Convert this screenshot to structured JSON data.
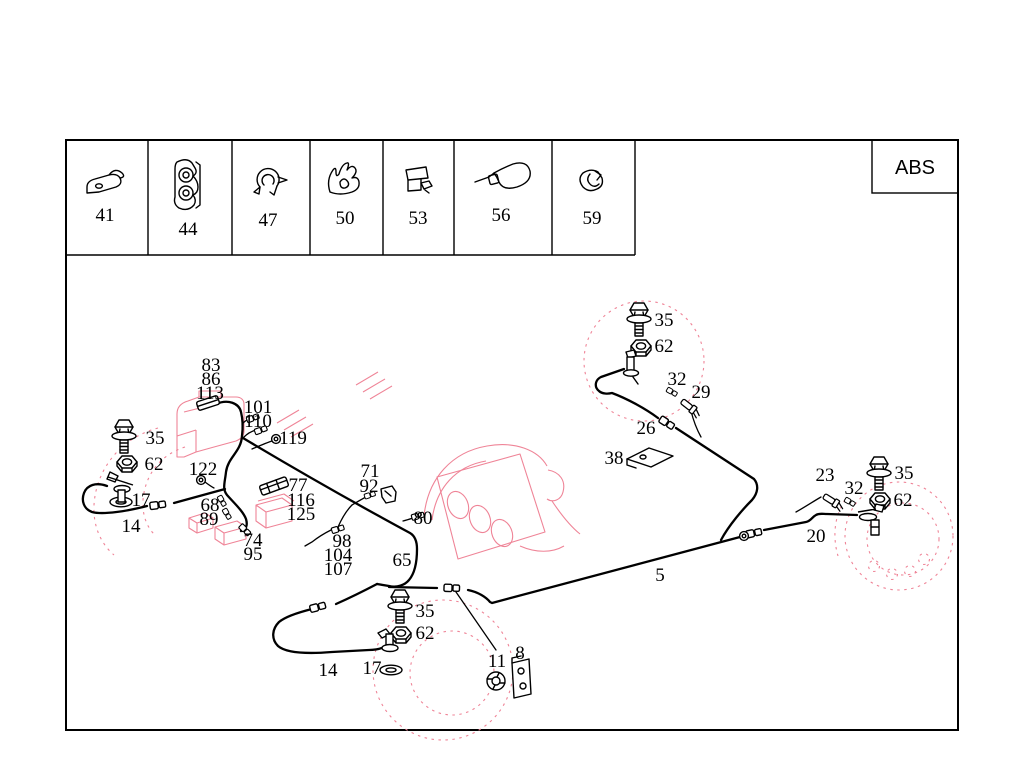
{
  "title": "brake-lines-abs-parts-diagram",
  "abs_badge": "ABS",
  "colors": {
    "line": "#000000",
    "ghost": "#ef8497",
    "background": "#ffffff"
  },
  "legend": [
    {
      "number": "41",
      "icon": "strap-clip"
    },
    {
      "number": "44",
      "icon": "double-pipe-clamp"
    },
    {
      "number": "47",
      "icon": "round-clip"
    },
    {
      "number": "50",
      "icon": "spring-clip"
    },
    {
      "number": "53",
      "icon": "bracket-clip"
    },
    {
      "number": "56",
      "icon": "cable-tie"
    },
    {
      "number": "59",
      "icon": "hose-clamp"
    }
  ],
  "callouts": [
    {
      "text": "41",
      "x": 105,
      "y": 221
    },
    {
      "text": "44",
      "x": 188,
      "y": 235
    },
    {
      "text": "47",
      "x": 268,
      "y": 226
    },
    {
      "text": "50",
      "x": 345,
      "y": 224
    },
    {
      "text": "53",
      "x": 418,
      "y": 224
    },
    {
      "text": "56",
      "x": 501,
      "y": 221
    },
    {
      "text": "59",
      "x": 592,
      "y": 224
    },
    {
      "text": "83",
      "x": 211,
      "y": 371
    },
    {
      "text": "86",
      "x": 211,
      "y": 385
    },
    {
      "text": "113",
      "x": 210,
      "y": 399
    },
    {
      "text": "101",
      "x": 258,
      "y": 413
    },
    {
      "text": "110",
      "x": 258,
      "y": 427
    },
    {
      "text": "119",
      "x": 293,
      "y": 444
    },
    {
      "text": "35",
      "x": 155,
      "y": 444
    },
    {
      "text": "62",
      "x": 154,
      "y": 470
    },
    {
      "text": "122",
      "x": 203,
      "y": 475
    },
    {
      "text": "17",
      "x": 141,
      "y": 506
    },
    {
      "text": "14",
      "x": 131,
      "y": 532
    },
    {
      "text": "68",
      "x": 210,
      "y": 511
    },
    {
      "text": "89",
      "x": 209,
      "y": 525
    },
    {
      "text": "77",
      "x": 298,
      "y": 491
    },
    {
      "text": "116",
      "x": 301,
      "y": 506
    },
    {
      "text": "125",
      "x": 301,
      "y": 520
    },
    {
      "text": "74",
      "x": 253,
      "y": 546
    },
    {
      "text": "95",
      "x": 253,
      "y": 560
    },
    {
      "text": "71",
      "x": 370,
      "y": 477
    },
    {
      "text": "92",
      "x": 369,
      "y": 492
    },
    {
      "text": "98",
      "x": 342,
      "y": 547
    },
    {
      "text": "104",
      "x": 338,
      "y": 561
    },
    {
      "text": "107",
      "x": 338,
      "y": 575
    },
    {
      "text": "80",
      "x": 423,
      "y": 524
    },
    {
      "text": "65",
      "x": 402,
      "y": 566
    },
    {
      "text": "35",
      "x": 425,
      "y": 617
    },
    {
      "text": "62",
      "x": 425,
      "y": 639
    },
    {
      "text": "17",
      "x": 372,
      "y": 674
    },
    {
      "text": "14",
      "x": 328,
      "y": 676
    },
    {
      "text": "11",
      "x": 497,
      "y": 667
    },
    {
      "text": "8",
      "x": 520,
      "y": 659
    },
    {
      "text": "5",
      "x": 660,
      "y": 581
    },
    {
      "text": "38",
      "x": 614,
      "y": 464
    },
    {
      "text": "26",
      "x": 646,
      "y": 434
    },
    {
      "text": "32",
      "x": 677,
      "y": 385
    },
    {
      "text": "29",
      "x": 701,
      "y": 398
    },
    {
      "text": "35",
      "x": 664,
      "y": 326
    },
    {
      "text": "62",
      "x": 664,
      "y": 352
    },
    {
      "text": "23",
      "x": 825,
      "y": 481
    },
    {
      "text": "32",
      "x": 854,
      "y": 494
    },
    {
      "text": "35",
      "x": 904,
      "y": 479
    },
    {
      "text": "62",
      "x": 903,
      "y": 506
    },
    {
      "text": "20",
      "x": 816,
      "y": 542
    }
  ]
}
